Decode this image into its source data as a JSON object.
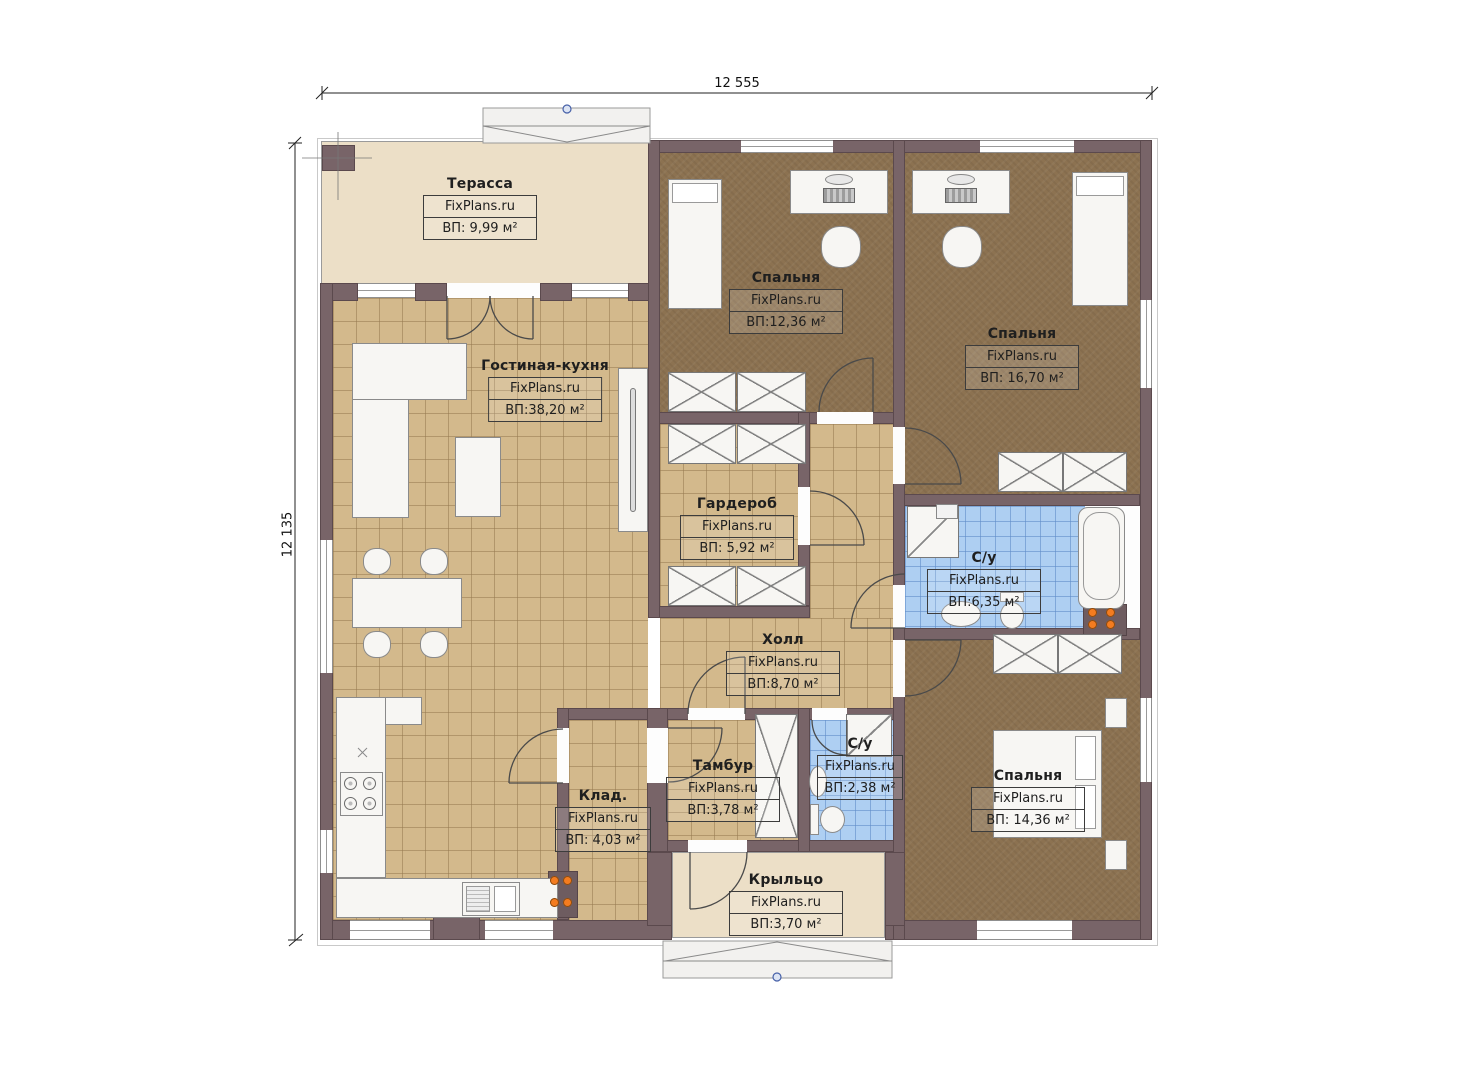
{
  "plan_title": "FixPlans house floor plan",
  "watermark": "FixPlans.ru",
  "dimensions": {
    "top": "12 555",
    "left": "12 135"
  },
  "rooms": [
    {
      "id": "terrace",
      "name": "Терасса",
      "area": "ВП: 9,99 м²"
    },
    {
      "id": "living",
      "name": "Гостиная-кухня",
      "area": "ВП:38,20 м²"
    },
    {
      "id": "bedroom1",
      "name": "Спальня",
      "area": "ВП:12,36 м²"
    },
    {
      "id": "bedroom2",
      "name": "Спальня",
      "area": "ВП: 16,70 м²"
    },
    {
      "id": "wardrobe",
      "name": "Гардероб",
      "area": "ВП: 5,92 м²"
    },
    {
      "id": "bath1",
      "name": "С/у",
      "area": "ВП:6,35 м²"
    },
    {
      "id": "hall",
      "name": "Холл",
      "area": "ВП:8,70 м²"
    },
    {
      "id": "tambour",
      "name": "Тамбур",
      "area": "ВП:3,78 м²"
    },
    {
      "id": "bath2",
      "name": "С/у",
      "area": "ВП:2,38 м²"
    },
    {
      "id": "storage",
      "name": "Клад.",
      "area": "ВП: 4,03 м²"
    },
    {
      "id": "bedroom3",
      "name": "Спальня",
      "area": "ВП: 14,36 м²"
    },
    {
      "id": "porch",
      "name": "Крыльцо",
      "area": "ВП:3,70 м²"
    }
  ],
  "colors": {
    "wall": "#786468",
    "floor_tile": "#d3b98c",
    "bedroom_carpet": "#8c7251",
    "bath_tile": "#aecff2",
    "terrace_deck": "#ecdfc7",
    "radiator": "#f47c20",
    "roof_marker": "#4660a8"
  }
}
